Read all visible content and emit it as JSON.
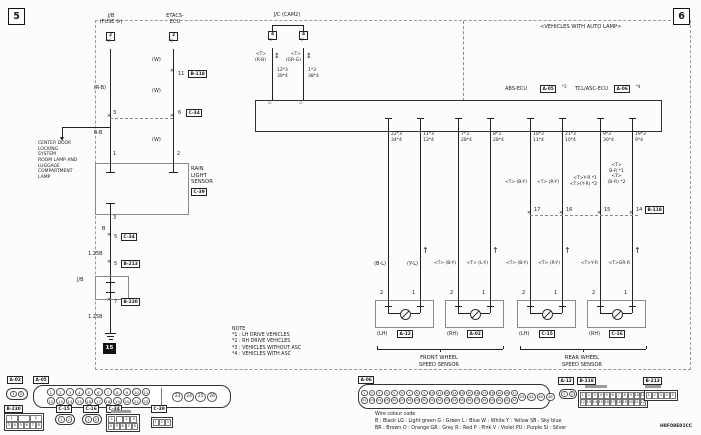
{
  "page": {
    "sec5": "5",
    "sec6": "6",
    "auto_lamp": "<VEHICLES WITH AUTO LAMP>",
    "code": "H8F08E01CC"
  },
  "icons": {
    "tri_down": "▽",
    "tri_up": "△",
    "arrow_up": "↑",
    "arrow_ud": "↕",
    "x": "✕"
  },
  "jb": {
    "title": "J/B\n(FUSE ⑩)",
    "pin": "2",
    "w1": "(R-B)",
    "j1": "3",
    "w2": "R-B",
    "p1": "1"
  },
  "branch": {
    "text": "CENTER DOOR\nLOCKING\nSYSTEM\nROOM LAMP AND\nLUGGAGE\nCOMPARTMENT\nLAMP"
  },
  "etacs": {
    "title": "ETACS-\nECU",
    "pin": "2",
    "w1": "(W)",
    "j1": "11",
    "j1c": "B-118",
    "w2": "(W)",
    "j2": "6",
    "j2c": "C-34",
    "w3": "(W)",
    "p2": "2"
  },
  "rls": {
    "name": "RAIN\nLIGHT\nSENSOR",
    "conn": "C-39",
    "p3": "3",
    "w1": "B",
    "j1": "5",
    "j1c": "C-34",
    "w2": "1.25B",
    "j2": "5",
    "j2c": "B-213",
    "jb": "J/B",
    "j3": "7",
    "j3c": "B-230",
    "w3": "1.25B",
    "gnd": "15"
  },
  "jc": {
    "title": "J/C (CAM2)",
    "pinl": "4",
    "pinr": "4",
    "wl": "<T>\n(R-B)",
    "wr": "<T>\n(GR-G)",
    "pl": "12*3\n39*4",
    "pr": "1*3\n38*4"
  },
  "ecu": {
    "l": "ABS-ECU",
    "lc": "A-05",
    "ln": "*3",
    "r": "TCL/ASC-ECU",
    "rc": "A-06",
    "rn": "*4"
  },
  "cols": [
    {
      "pins": "22*3\n34*4",
      "mid": "",
      "jn": "",
      "wire": "(B-L)"
    },
    {
      "pins": "11*3\n13*4",
      "mid": "",
      "jn": "",
      "wire": "(Y-L)"
    },
    {
      "pins": "7*3\n28*4",
      "mid": "",
      "jn": "",
      "wire": "<T> (B-Y)"
    },
    {
      "pins": "8*3\n28*4",
      "mid": "",
      "jn": "",
      "wire": "<T> (L-Y)"
    },
    {
      "pins": "10*3\n11*4",
      "mid": "<T> (B-Y)",
      "jn": "17",
      "wire": "<T> (B-Y)"
    },
    {
      "pins": "21*3\n10*4",
      "mid": "<T> (R-Y)",
      "jn": "16",
      "wire": "<T> (R-Y)"
    },
    {
      "pins": "9*3\n30*4",
      "mid": "<T>Y-R *1\n<T>(Y-R) *2",
      "jn": "15",
      "wire": "<T>Y-R"
    },
    {
      "pins": "19*3\n9*4",
      "mid": "<T>\nB-R *1\n<T>\n(B-R) *2",
      "jn": "14",
      "wire": "<T>GR-R"
    }
  ],
  "bj": {
    "conn": "B-118"
  },
  "sensors": [
    {
      "pl": "2",
      "pr": "1",
      "pos": "(LH)",
      "conn": "A-12"
    },
    {
      "pl": "2",
      "pr": "1",
      "pos": "(RH)",
      "conn": "A-02"
    },
    {
      "pl": "2",
      "pr": "1",
      "pos": "(LH)",
      "conn": "C-15"
    },
    {
      "pl": "2",
      "pr": "1",
      "pos": "(RH)",
      "conn": "C-16"
    }
  ],
  "groups": {
    "front": "FRONT WHEEL\nSPEED SENSOR",
    "rear": "REAR WHEEL\nSPEED SENSOR"
  },
  "note": {
    "text": "NOTE\n*1 : LH DRIVE VEHICLES\n*2 : RH DRIVE VEHICLES\n*3 : VEHICLES WITHOUT ASC\n*4 : VEHICLES WITH ASC"
  },
  "legend": {
    "title": "Wire colour code",
    "l1": "B : Black      LG : Light green      G : Green      L : Blue      W : White      Y : Yellow      SB : Sky blue",
    "l2": "BR : Brown      O : Orange      GR : Grey      R : Red      P : Pink      V : Violet      PU : Purple      SI : Silver"
  },
  "conn": {
    "a02": {
      "label": "A-02",
      "pins": [
        "1",
        "2"
      ]
    },
    "a05": {
      "label": "A-05",
      "r1": [
        "1",
        "2",
        "3",
        "4",
        "5",
        "6",
        "7",
        "8",
        "9",
        "10",
        "11"
      ],
      "r2": [
        "12",
        "13",
        "14",
        "15",
        "16",
        "17",
        "18",
        "19",
        "20",
        "21",
        "22"
      ],
      "r3": [
        "23",
        "24",
        "25",
        "26"
      ]
    },
    "b230": {
      "label": "B-230",
      "r1": [
        "1",
        "",
        "2"
      ],
      "r2": [
        "3",
        "4",
        "5",
        "6",
        "7",
        "8"
      ]
    },
    "c15": {
      "label": "C-15",
      "pins": [
        "1",
        "2"
      ]
    },
    "c16": {
      "label": "C-16",
      "pins": [
        "1",
        "2"
      ]
    },
    "c34": {
      "label": "C-34",
      "r1": [
        "1",
        "",
        "2",
        "3"
      ],
      "r2": [
        "4",
        "5",
        "6",
        "7",
        "8"
      ]
    },
    "c39": {
      "label": "C-39",
      "r1": [
        "1",
        "2",
        "3"
      ]
    },
    "a06": {
      "label": "A-06",
      "r1": [
        "1",
        "2",
        "3",
        "4",
        "5",
        "6",
        "7",
        "8",
        "9",
        "10",
        "11",
        "12",
        "13",
        "14",
        "15",
        "16",
        "17",
        "18",
        "19",
        "20",
        "21"
      ],
      "r2": [
        "22",
        "23",
        "24",
        "25",
        "26",
        "27",
        "28",
        "29",
        "30",
        "31",
        "32",
        "33",
        "34",
        "35",
        "36",
        "37",
        "38",
        "39",
        "40",
        "41",
        "42"
      ],
      "r3": [
        "43",
        "44",
        "45",
        "46"
      ]
    },
    "a12": {
      "label": "A-12",
      "pins": [
        "1",
        "2"
      ]
    },
    "b118": {
      "label": "B-118",
      "r1": [
        "1",
        "2",
        "3",
        "4",
        "5",
        "6",
        "7",
        "8",
        "9",
        "10",
        "11"
      ],
      "r2": [
        "12",
        "13",
        "14",
        "15",
        "16",
        "17",
        "18",
        "19",
        "20",
        "21",
        "22"
      ]
    },
    "b213": {
      "label": "B-213",
      "r1": [
        "1",
        "2",
        "3",
        "4",
        "5"
      ]
    }
  }
}
